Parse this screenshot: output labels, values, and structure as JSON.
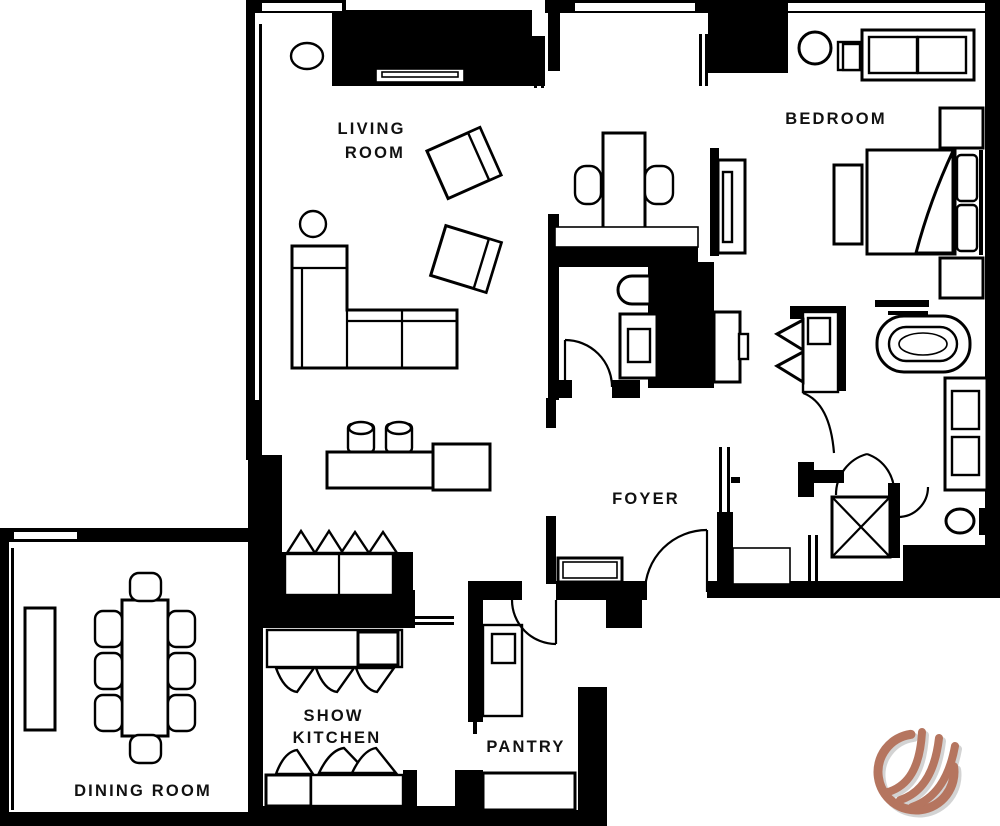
{
  "document": {
    "type": "residential-floor-plan"
  },
  "colors": {
    "walls": "#000000",
    "floor": "#ffffff",
    "label_text": "#111111",
    "logo_copper": "#b5755f",
    "logo_shadow": "#c9c9c9"
  },
  "labels": {
    "living_room": [
      "LIVING",
      "ROOM"
    ],
    "bedroom": "BEDROOM",
    "foyer": "FOYER",
    "dining_room": "DINING ROOM",
    "show_kitchen": [
      "SHOW",
      "KITCHEN"
    ],
    "pantry": "PANTRY"
  },
  "furniture_icons": [
    "sectional-sofa-icon",
    "armchair-icon",
    "round-side-table-icon",
    "tv-console-icon",
    "bar-counter-icon",
    "bar-stool-icon",
    "desk-icon",
    "desk-chair-icon",
    "wall-tv-icon",
    "bed-icon",
    "pillow-icon",
    "nightstand-icon",
    "bench-icon",
    "loveseat-icon",
    "round-table-icon",
    "bathtub-icon",
    "vanity-sink-icon",
    "toilet-icon",
    "wardrobe-x-icon",
    "storage-cabinet-icon",
    "dining-table-icon",
    "dining-chair-icon",
    "sideboard-icon",
    "kitchen-island-icon",
    "upper-cabinet-icon",
    "counter-icon",
    "door-swing-icon",
    "window-icon"
  ],
  "logo": {
    "name": "flame-swoosh-logo"
  }
}
